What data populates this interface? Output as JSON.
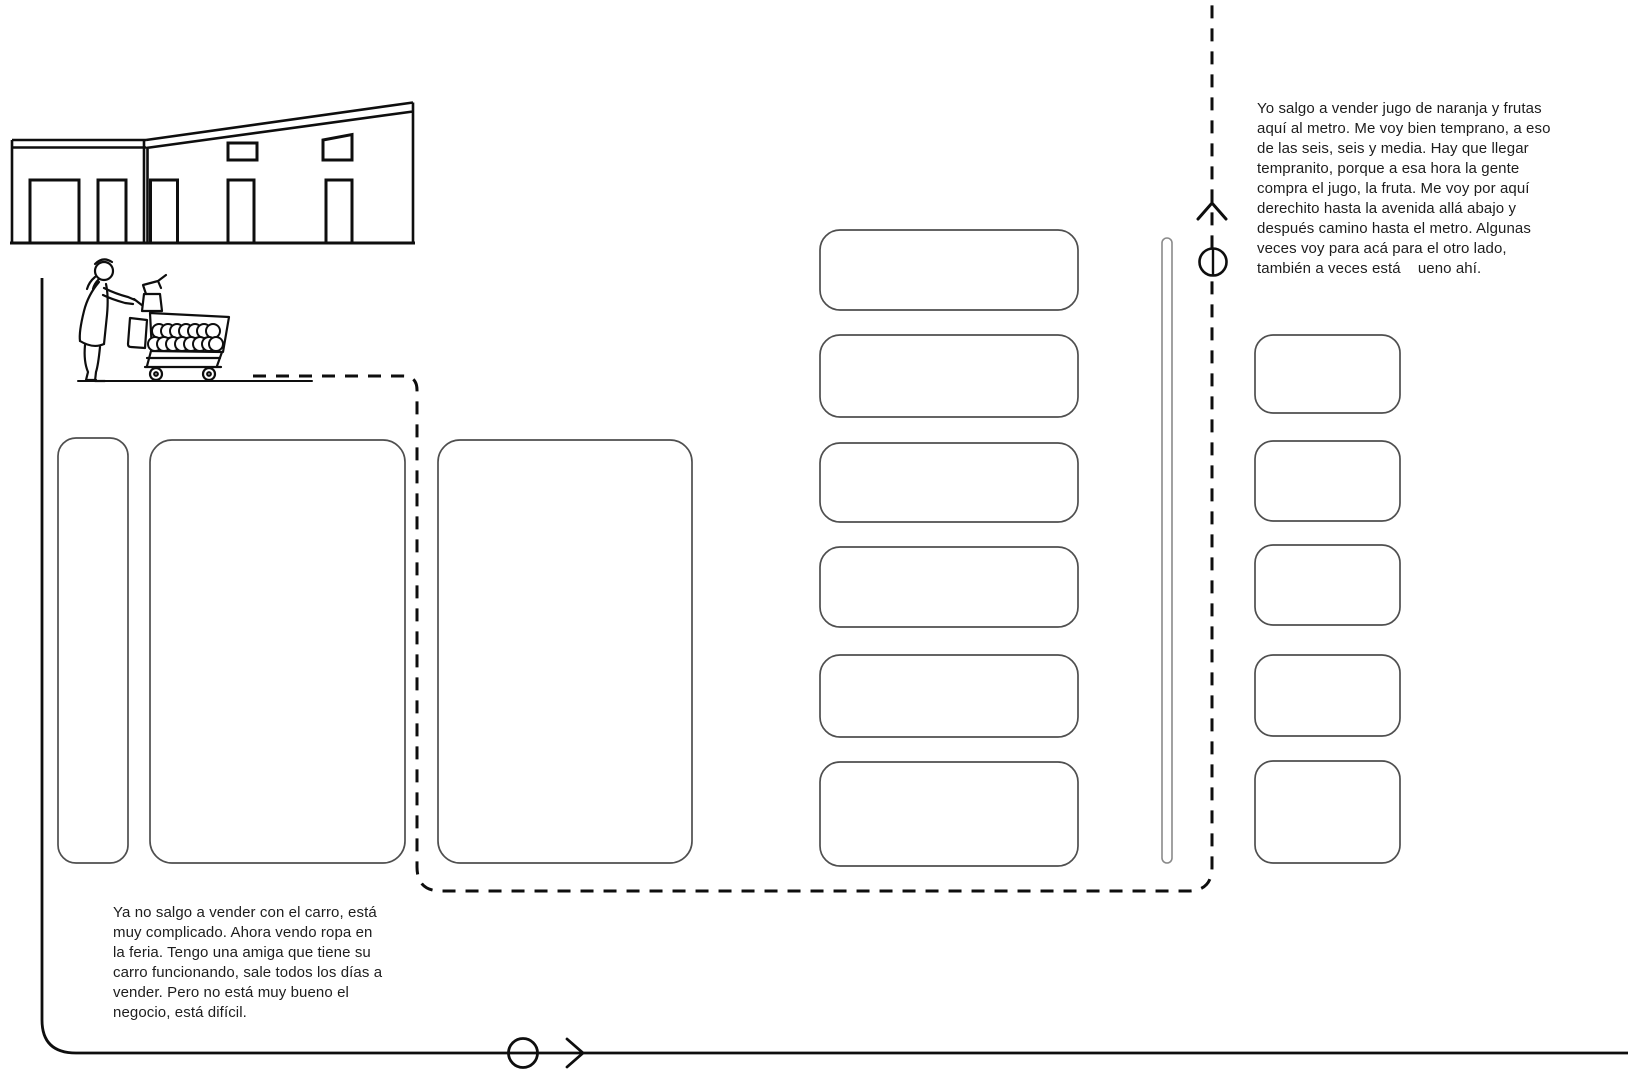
{
  "canvas": {
    "width": 1628,
    "height": 1080,
    "background": "#ffffff"
  },
  "colors": {
    "ink": "#0e0e0e",
    "block_outline": "#4f4f4f",
    "divider_bar_outline": "#8a8a8a",
    "text": "#1d1d1d"
  },
  "annotations": {
    "metro_vendor_quote": "Yo salgo a vender jugo de naranja y frutas\naquí al metro. Me voy bien temprano, a eso\nde las seis, seis y media. Hay que llegar\ntempranito, porque a esa hora la gente\ncompra el jugo, la fruta. Me voy por aquí\nderechito hasta la avenida allá abajo y\ndespués camino hasta el metro. Algunas\nveces voy para acá para el otro lado,\ntambién a veces está    ueno ahí.",
    "feria_vendor_quote": "Ya no salgo a vender con el carro, está\nmuy complicado. Ahora vendo ropa en\nla feria. Tengo una amiga que tiene su\ncarro funcionando, sale todos los días a\nvender. Pero no está muy bueno el\nnegocio, está difícil."
  },
  "icons": {
    "market_building": "line drawing of market warehouse with doors and windows",
    "vendor_with_cart": "line drawing of woman pushing cart full of oranges with juicer",
    "route_up_arrow": "chevron-up on dashed walking route",
    "metro_station_marker": "circle marker on dashed walking route",
    "route_right_arrow": "chevron-right on avenue line",
    "avenue_stop_marker": "circle marker on avenue line"
  }
}
